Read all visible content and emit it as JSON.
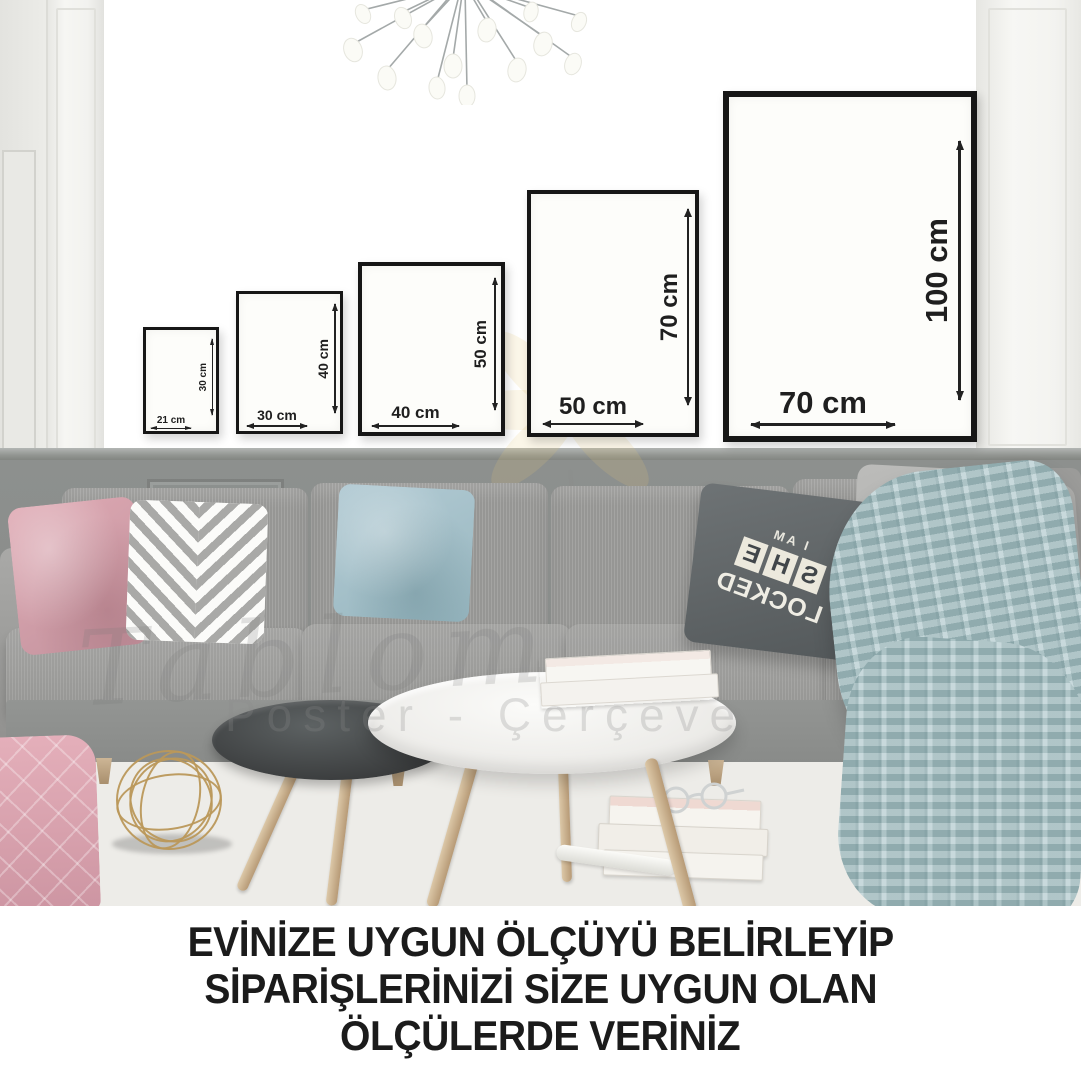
{
  "caption": {
    "line1": "EVİNİZE UYGUN ÖLÇÜYÜ BELİRLEYİP",
    "line2": "SİPARİŞLERİNİZİ SİZE UYGUN OLAN",
    "line3": "ÖLÇÜLERDE VERİNİZ"
  },
  "frames": [
    {
      "id": "21x30",
      "width_label": "21 cm",
      "height_label": "30 cm"
    },
    {
      "id": "30x40",
      "width_label": "30 cm",
      "height_label": "40 cm"
    },
    {
      "id": "40x50",
      "width_label": "40 cm",
      "height_label": "50 cm"
    },
    {
      "id": "50x70",
      "width_label": "50 cm",
      "height_label": "70 cm"
    },
    {
      "id": "70x100",
      "width_label": "70 cm",
      "height_label": "100 cm"
    }
  ],
  "pillow_print": {
    "line1": "I AM",
    "line2": "SHE",
    "line3": "LOCKED",
    "mirrored": true
  },
  "watermark": {
    "brand_script": "Tablom",
    "subtitle": "Poster - Çerçeve"
  },
  "colors": {
    "wall": "#f4f4f1",
    "wainscot": "#898c8a",
    "frame_border": "#161616",
    "dimension_text": "#1f1f1f",
    "sofa": "#9e9e9c",
    "pink_pillow": "#d5a3ad",
    "blue_pillow": "#a9c4cd",
    "dark_pillow": "#5f6466",
    "blanket": "#a6c3c6",
    "rug_pattern": "#a0a09e",
    "wood": "#c9b190",
    "gold_sphere": "#ba985a",
    "caption_text": "#1b1b1b"
  }
}
